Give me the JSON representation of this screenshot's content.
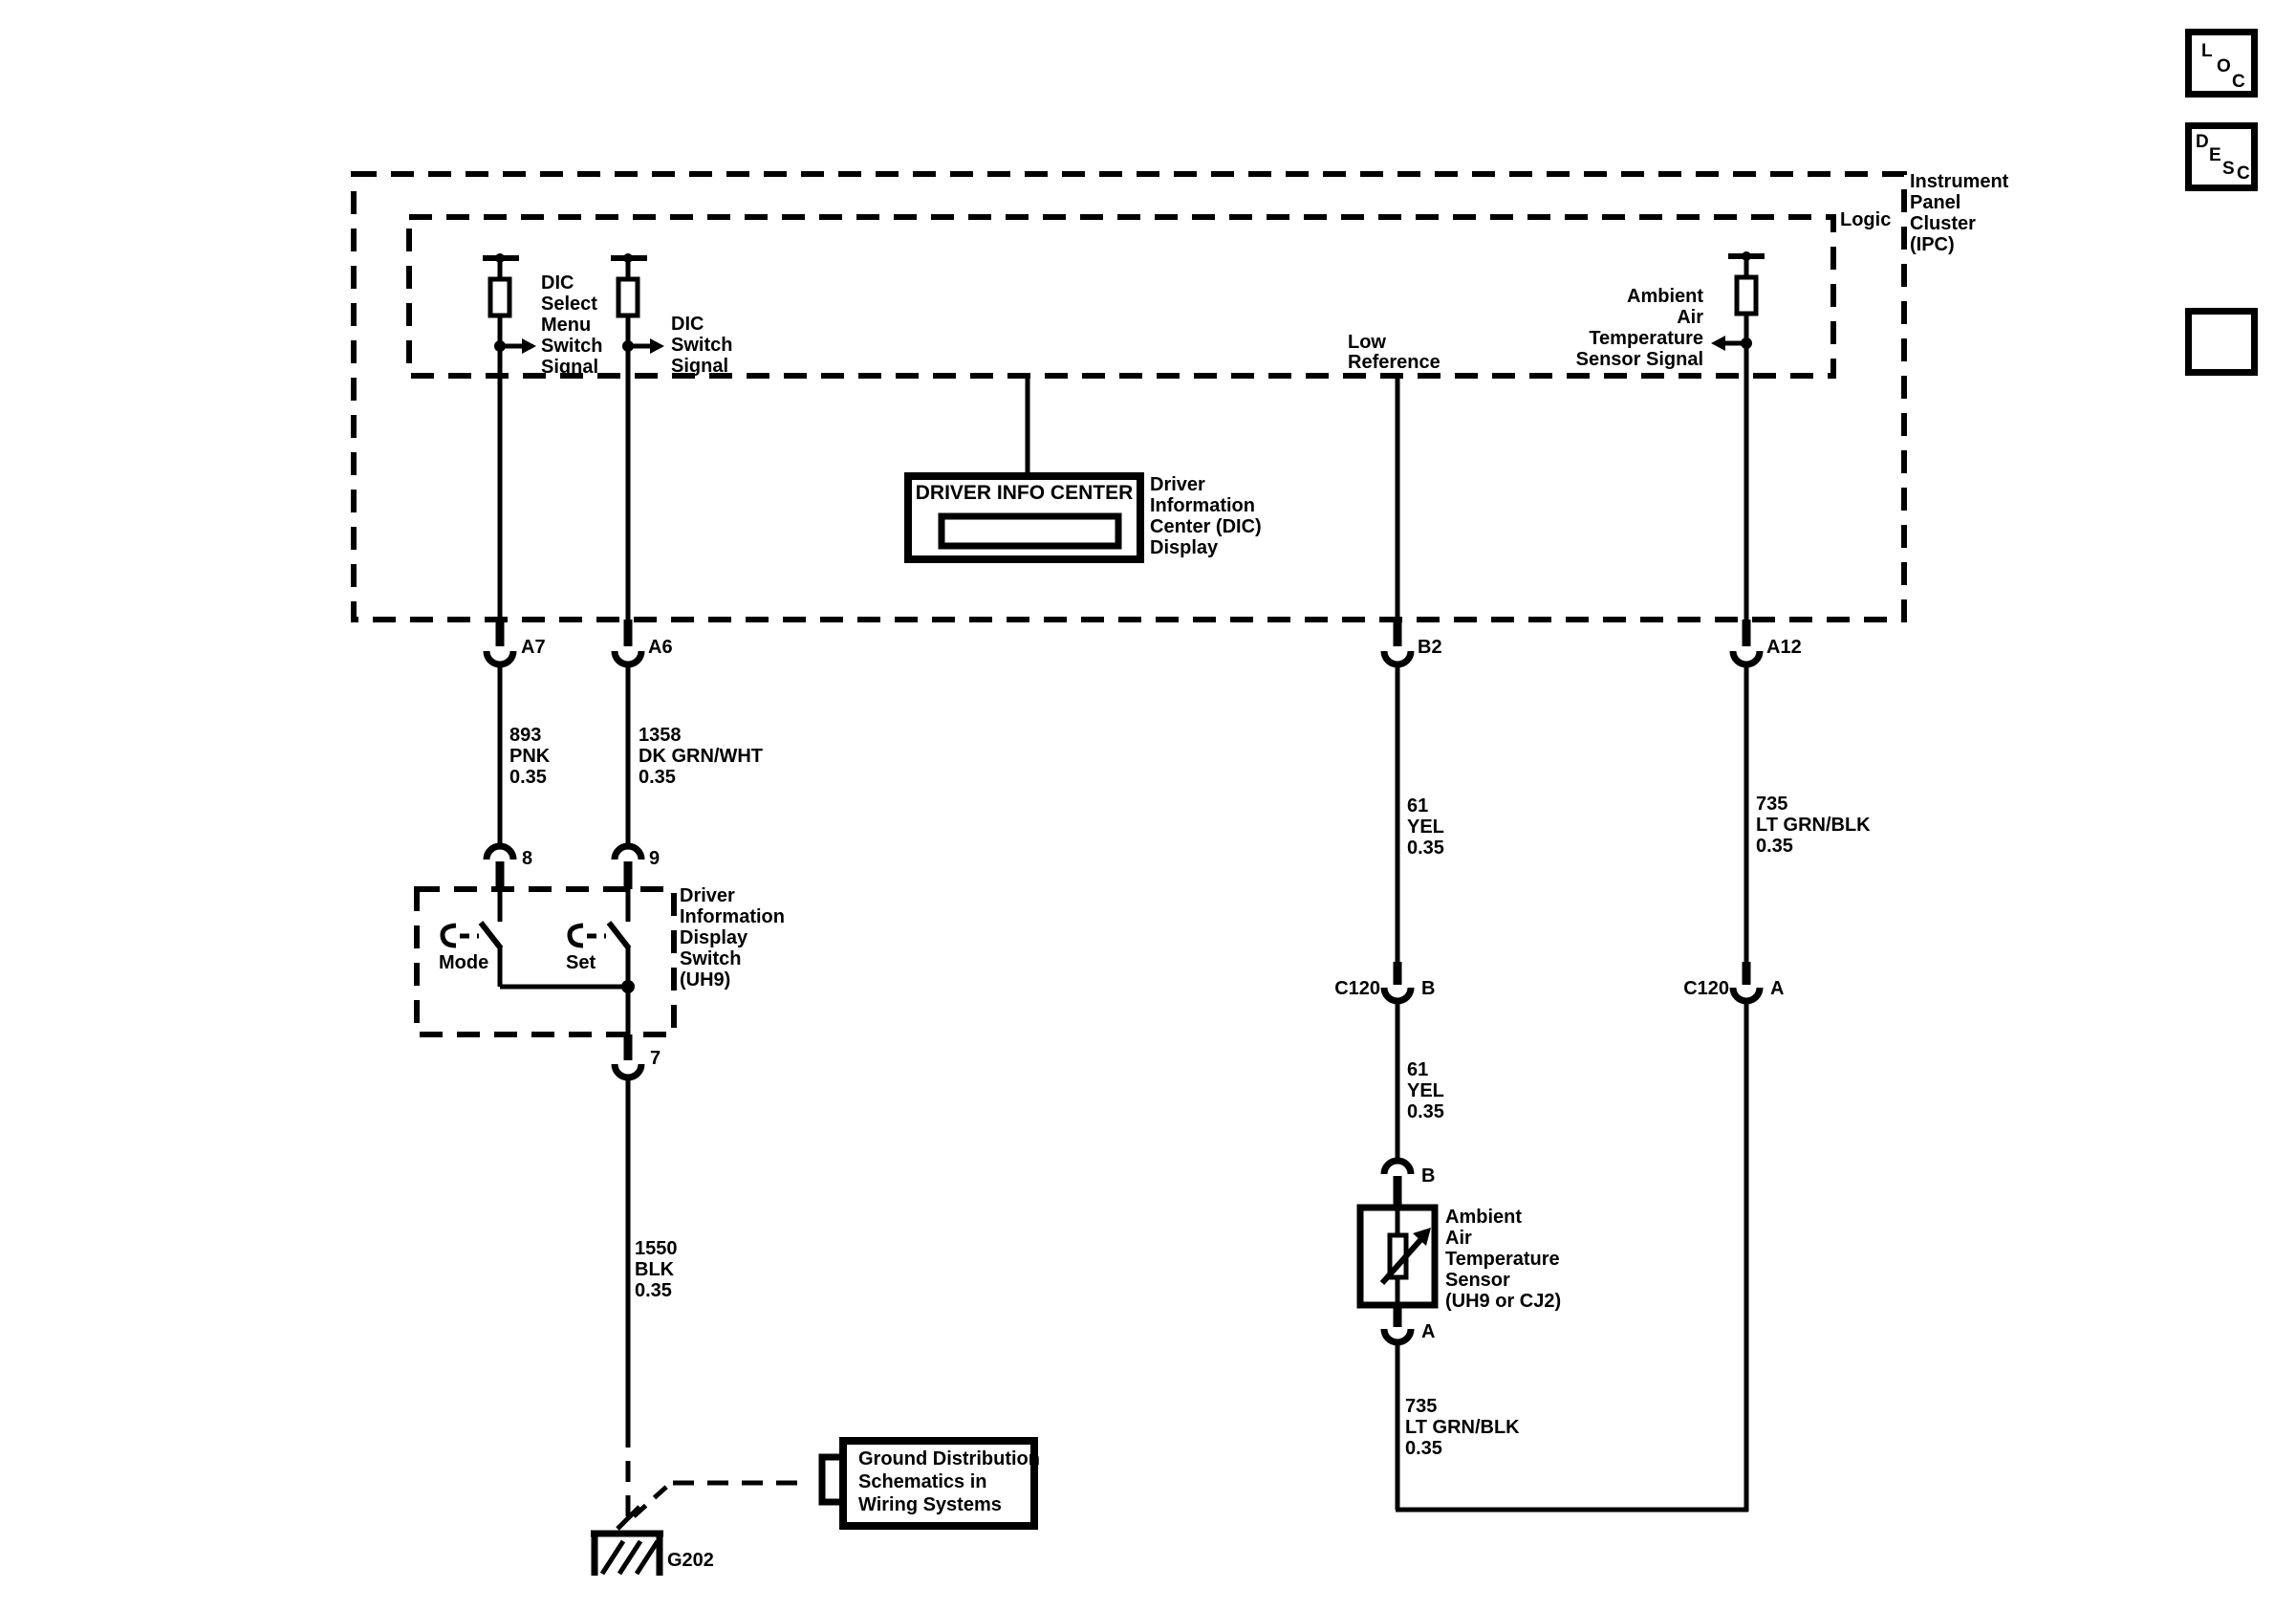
{
  "colors": {
    "line": "#000000",
    "background": "#ffffff"
  },
  "ipc": {
    "name_lines": [
      "Instrument",
      "Panel",
      "Cluster",
      "(IPC)"
    ],
    "logic_label": "Logic"
  },
  "signals": {
    "dic_select_lines": [
      "DIC",
      "Select",
      "Menu",
      "Switch",
      "Signal"
    ],
    "dic_switch_lines": [
      "DIC",
      "Switch",
      "Signal"
    ],
    "low_reference_lines": [
      "Low",
      "Reference"
    ],
    "aat_signal_lines": [
      "Ambient",
      "Air",
      "Temperature",
      "Sensor Signal"
    ]
  },
  "dic_display": {
    "box_title": "DRIVER INFO CENTER",
    "label_lines": [
      "Driver",
      "Information",
      "Center (DIC)",
      "Display"
    ]
  },
  "connectors": {
    "a7": "A7",
    "a6": "A6",
    "b2": "B2",
    "a12": "A12",
    "pin8": "8",
    "pin9": "9",
    "pin7": "7",
    "c120": "C120",
    "c120_pin_b": "B",
    "c120_pin_a": "A",
    "sensor_pin_b": "B",
    "sensor_pin_a": "A"
  },
  "wires": {
    "w893": [
      "893",
      "PNK",
      "0.35"
    ],
    "w1358": [
      "1358",
      "DK GRN/WHT",
      "0.35"
    ],
    "w1550": [
      "1550",
      "BLK",
      "0.35"
    ],
    "w61_upper": [
      "61",
      "YEL",
      "0.35"
    ],
    "w61_lower": [
      "61",
      "YEL",
      "0.35"
    ],
    "w735_right": [
      "735",
      "LT GRN/BLK",
      "0.35"
    ],
    "w735_lower": [
      "735",
      "LT GRN/BLK",
      "0.35"
    ]
  },
  "switch_box": {
    "label_lines": [
      "Driver",
      "Information",
      "Display",
      "Switch",
      "(UH9)"
    ],
    "mode_label": "Mode",
    "set_label": "Set"
  },
  "sensor": {
    "label_lines": [
      "Ambient",
      "Air",
      "Temperature",
      "Sensor",
      "(UH9 or CJ2)"
    ]
  },
  "ground": {
    "ref_label": "G202",
    "box_lines": [
      "Ground Distribution",
      "Schematics in",
      "Wiring Systems"
    ]
  },
  "toolbar": {
    "loc_letters": [
      "L",
      "O",
      "C"
    ],
    "desc_letters": [
      "D",
      "E",
      "S",
      "C"
    ]
  }
}
